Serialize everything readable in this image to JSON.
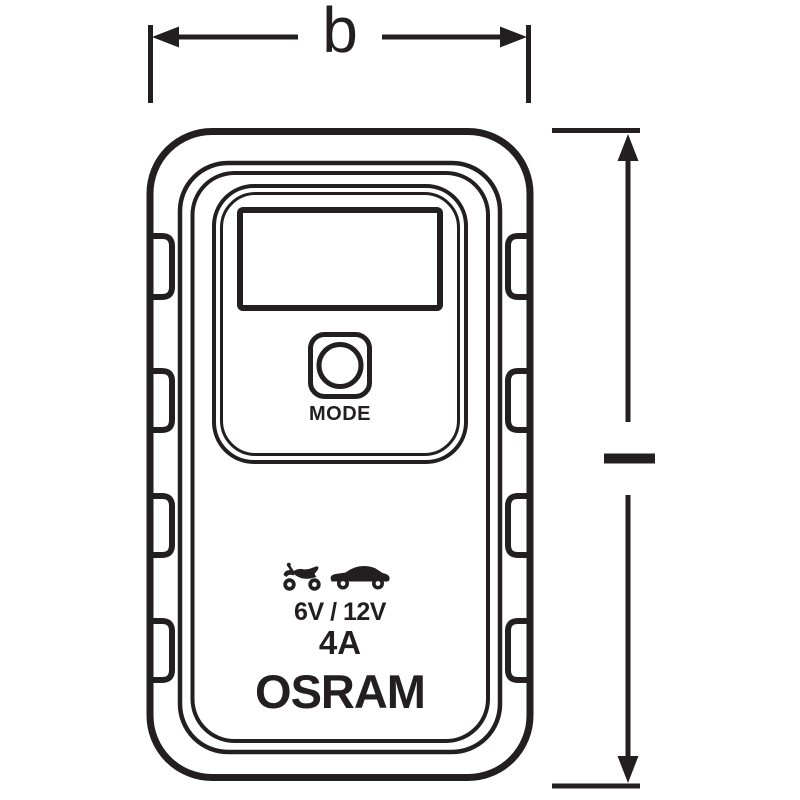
{
  "drawing": {
    "type": "technical-dimension-drawing",
    "subject": "battery charger front view",
    "width_dimension_label": "b",
    "device": {
      "mode_button_label": "MODE",
      "voltage_label": "6V / 12V",
      "current_label": "4A",
      "brand_label": "OSRAM",
      "vehicle_icons": [
        {
          "name": "motorcycle-icon"
        },
        {
          "name": "car-icon"
        }
      ]
    },
    "colors": {
      "line": "#231f20",
      "background": "#ffffff"
    }
  }
}
